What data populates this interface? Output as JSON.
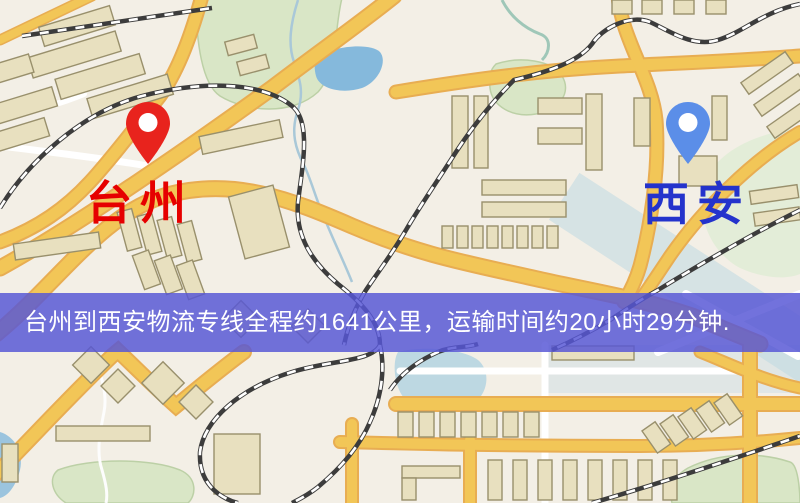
{
  "map": {
    "origin": {
      "label": "台州",
      "pin_icon": "red-location-pin"
    },
    "destination": {
      "label": "西安",
      "pin_icon": "blue-location-pin"
    }
  },
  "banner": {
    "text": "台州到西安物流专线全程约1641公里，运输时间约20小时29分钟."
  },
  "colors": {
    "map-bg": "#f3efe6",
    "road": "#f2c657",
    "road-edge": "#e8ad52",
    "minor-road": "#ffffff",
    "park": "#d9e6c6",
    "park-edge": "#bcd0a6",
    "water": "#85b9dc",
    "water-light": "#bdd8e2",
    "building": "#e8e0bf",
    "building-edge": "#99906c",
    "rail": "#3c3c3c",
    "origin-pin": "#e8231d",
    "origin-label": "#e60000",
    "destination-pin": "#5b8ee8",
    "destination-label": "#2433cc",
    "banner-bg": "#5757d5",
    "banner-text": "#ffffff"
  }
}
